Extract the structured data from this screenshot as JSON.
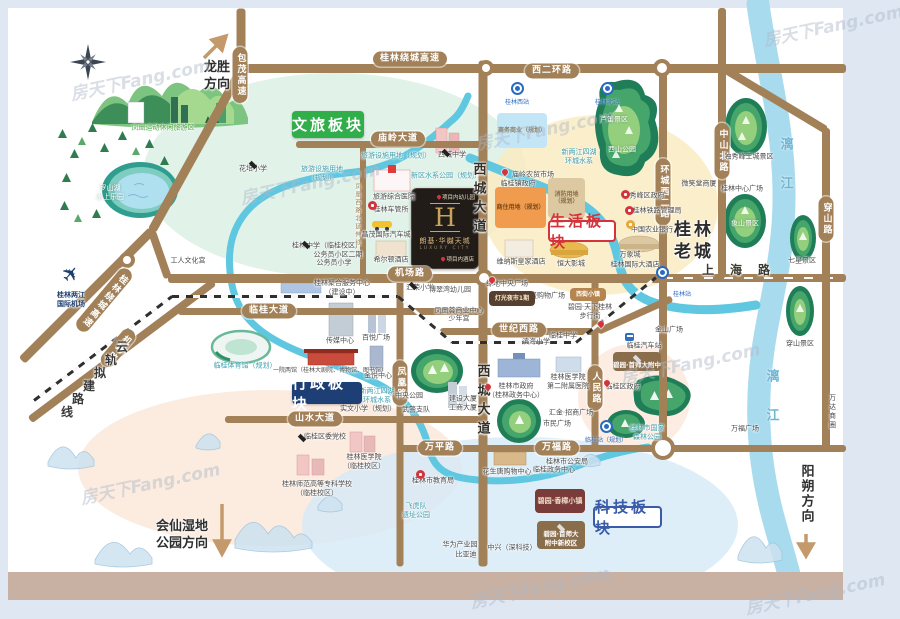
{
  "watermark": "房天下Fang.com",
  "colors": {
    "road": "#a28159",
    "green_badge": "#2fae49",
    "navy_badge": "#1e3e76",
    "red_accent": "#d5333b",
    "blue_accent": "#3a5ba8",
    "river": "#5fc7e0",
    "liriver": "#a9dbee"
  },
  "project": {
    "letter": "H",
    "name": "朗基·华樾天城",
    "subtitle": "LUXURY CITY",
    "kindergarten": "项目内幼儿园",
    "hotel": "项目内酒店"
  },
  "badges": [
    {
      "t": "文旅板块",
      "x": 292,
      "y": 111,
      "w": 72,
      "h": 27,
      "style": "solid",
      "bg": "#2fae49"
    },
    {
      "t": "生活板块",
      "x": 548,
      "y": 220,
      "w": 68,
      "h": 22,
      "style": "outline",
      "color": "#d5333b"
    },
    {
      "t": "行政板块",
      "x": 292,
      "y": 382,
      "w": 70,
      "h": 22,
      "style": "solid",
      "bg": "#1e3e76"
    },
    {
      "t": "科技板块",
      "x": 593,
      "y": 506,
      "w": 69,
      "h": 22,
      "style": "outline",
      "color": "#3a5ba8"
    }
  ],
  "directions": [
    {
      "t": "龙胜\n方向",
      "x": 217,
      "y": 77,
      "vert": 0
    },
    {
      "t": "会仙湿地\n公园方向",
      "x": 182,
      "y": 536,
      "vert": 0
    },
    {
      "t": "阳朔方向",
      "x": 805,
      "y": 494,
      "vert": 1
    }
  ],
  "roads": [
    {
      "x1": 237,
      "y1": 68,
      "x2": 846,
      "y2": 68,
      "w": 9
    },
    {
      "x1": 241,
      "y1": 8,
      "x2": 241,
      "y2": 70,
      "w": 9
    },
    {
      "x1": 243,
      "y1": 66,
      "x2": 152,
      "y2": 230,
      "w": 9
    },
    {
      "x1": 152,
      "y1": 230,
      "x2": 22,
      "y2": 360,
      "w": 9
    },
    {
      "x1": 214,
      "y1": 282,
      "x2": 30,
      "y2": 420,
      "w": 8
    },
    {
      "x1": 168,
      "y1": 278,
      "x2": 152,
      "y2": 232,
      "w": 8
    },
    {
      "x1": 296,
      "y1": 144,
      "x2": 484,
      "y2": 144,
      "w": 7
    },
    {
      "x1": 168,
      "y1": 278,
      "x2": 662,
      "y2": 278,
      "w": 9
    },
    {
      "x1": 662,
      "y1": 278,
      "x2": 846,
      "y2": 278,
      "w": 8,
      "cls": "dashcenter"
    },
    {
      "x1": 178,
      "y1": 311,
      "x2": 484,
      "y2": 311,
      "w": 7
    },
    {
      "x1": 440,
      "y1": 331,
      "x2": 598,
      "y2": 331,
      "w": 7
    },
    {
      "x1": 598,
      "y1": 331,
      "x2": 672,
      "y2": 298,
      "w": 7
    },
    {
      "x1": 225,
      "y1": 419,
      "x2": 484,
      "y2": 419,
      "w": 7
    },
    {
      "x1": 398,
      "y1": 448,
      "x2": 484,
      "y2": 448,
      "w": 7
    },
    {
      "x1": 484,
      "y1": 448,
      "x2": 846,
      "y2": 448,
      "w": 7
    },
    {
      "x1": 483,
      "y1": 60,
      "x2": 483,
      "y2": 566,
      "w": 9
    },
    {
      "x1": 363,
      "y1": 144,
      "x2": 363,
      "y2": 280,
      "w": 6
    },
    {
      "x1": 400,
      "y1": 278,
      "x2": 400,
      "y2": 566,
      "w": 7
    },
    {
      "x1": 595,
      "y1": 278,
      "x2": 595,
      "y2": 450,
      "w": 7
    },
    {
      "x1": 663,
      "y1": 68,
      "x2": 663,
      "y2": 450,
      "w": 8
    },
    {
      "x1": 722,
      "y1": 8,
      "x2": 722,
      "y2": 278,
      "w": 8
    },
    {
      "x1": 826,
      "y1": 128,
      "x2": 826,
      "y2": 450,
      "w": 8
    },
    {
      "x1": 726,
      "y1": 70,
      "x2": 826,
      "y2": 130,
      "w": 8
    }
  ],
  "rails": [
    {
      "x1": 34,
      "y1": 400,
      "x2": 172,
      "y2": 296
    },
    {
      "x1": 172,
      "y1": 296,
      "x2": 398,
      "y2": 296
    },
    {
      "x1": 398,
      "y1": 296,
      "x2": 452,
      "y2": 342
    },
    {
      "x1": 452,
      "y1": 342,
      "x2": 576,
      "y2": 342
    },
    {
      "x1": 576,
      "y1": 342,
      "x2": 656,
      "y2": 277
    }
  ],
  "junctions": [
    {
      "x": 486,
      "y": 68,
      "r": 8
    },
    {
      "x": 662,
      "y": 68,
      "r": 9
    },
    {
      "x": 484,
      "y": 278,
      "r": 9
    },
    {
      "x": 663,
      "y": 448,
      "r": 12
    },
    {
      "x": 127,
      "y": 260,
      "r": 8
    }
  ],
  "pills": [
    {
      "t": "桂林绕城高速",
      "x": 410,
      "y": 59
    },
    {
      "t": "西二环路",
      "x": 552,
      "y": 71
    },
    {
      "t": "包茂高速",
      "x": 240,
      "y": 75,
      "vert": 1
    },
    {
      "t": "庙岭大道",
      "x": 398,
      "y": 139
    },
    {
      "t": "机场路",
      "x": 410,
      "y": 274
    },
    {
      "t": "临桂大道",
      "x": 269,
      "y": 311
    },
    {
      "t": "世纪西路",
      "x": 519,
      "y": 330
    },
    {
      "t": "山水大道",
      "x": 315,
      "y": 419
    },
    {
      "t": "万平路",
      "x": 440,
      "y": 448
    },
    {
      "t": "万福路",
      "x": 557,
      "y": 448
    },
    {
      "t": "凤凰路",
      "x": 400,
      "y": 383,
      "vert": 1
    },
    {
      "t": "人民路",
      "x": 595,
      "y": 388,
      "vert": 1
    },
    {
      "t": "环城西二路",
      "x": 663,
      "y": 192,
      "vert": 1
    },
    {
      "t": "中山北路",
      "x": 722,
      "y": 151,
      "vert": 1
    },
    {
      "t": "穿山路",
      "x": 826,
      "y": 219,
      "vert": 1
    },
    {
      "t": "桂林绕城高速",
      "x": 104,
      "y": 300,
      "vert": 1,
      "rot": 40
    },
    {
      "t": "机场路",
      "x": 118,
      "y": 348,
      "vert": 1,
      "rot": 40
    }
  ],
  "stations": [
    {
      "t": "桂林西站",
      "x": 517,
      "y": 88
    },
    {
      "t": "桂林北站",
      "x": 607,
      "y": 88
    },
    {
      "t": "桂林站",
      "x": 662,
      "y": 272,
      "lx": 682,
      "ly": 289
    },
    {
      "t": "临桂站（规划）",
      "x": 606,
      "y": 426
    }
  ],
  "railchars": [
    [
      "云",
      122,
      348
    ],
    [
      "轨",
      111,
      361
    ],
    [
      "拟",
      100,
      374
    ],
    [
      "建",
      89,
      387
    ],
    [
      "路",
      78,
      400
    ],
    [
      "线",
      67,
      413
    ]
  ],
  "pois": [
    {
      "t": "凤凰运动休闲旅游区",
      "x": 163,
      "y": 128,
      "c": "g"
    },
    {
      "t": "罗山湖\n水上乐园",
      "x": 110,
      "y": 193,
      "c": "w"
    },
    {
      "t": "花培小学",
      "x": 253,
      "y": 169
    },
    {
      "t": "旅游设施用地（规划）",
      "x": 396,
      "y": 156,
      "c": "t"
    },
    {
      "t": "旅游设施用地\n（规划）",
      "x": 322,
      "y": 174,
      "c": "t"
    },
    {
      "t": "新区水系公园（规划）",
      "x": 446,
      "y": 176,
      "c": "t"
    },
    {
      "t": "西城中学",
      "x": 452,
      "y": 155
    },
    {
      "t": "旅游综合医院",
      "x": 394,
      "y": 197
    },
    {
      "t": "桂林车管所",
      "x": 391,
      "y": 210
    },
    {
      "t": "昌茂国际汽车城",
      "x": 386,
      "y": 235
    },
    {
      "t": "希尔顿酒店",
      "x": 391,
      "y": 260
    },
    {
      "t": "桂林中学（临桂校区）",
      "x": 327,
      "y": 246
    },
    {
      "t": "公务员小区二期",
      "x": 338,
      "y": 255
    },
    {
      "t": "公务员小学",
      "x": 334,
      "y": 263
    },
    {
      "t": "工人文化宫",
      "x": 188,
      "y": 261
    },
    {
      "t": "桂林两江\n国际机场",
      "x": 71,
      "y": 300,
      "c": "nav"
    },
    {
      "t": "桂林聚合服务中心\n（建设中）",
      "x": 342,
      "y": 288
    },
    {
      "t": "临桂体育馆（规划）",
      "x": 245,
      "y": 366,
      "c": "t"
    },
    {
      "t": "传媒中心",
      "x": 340,
      "y": 341
    },
    {
      "t": "百悦广场",
      "x": 376,
      "y": 338
    },
    {
      "t": "一院两馆（桂林大剧院、博物馆、图书馆）",
      "x": 330,
      "y": 371,
      "c": "sm"
    },
    {
      "t": "金悦中心",
      "x": 378,
      "y": 376
    },
    {
      "t": "新两江四湖\n环城水系",
      "x": 377,
      "y": 396,
      "c": "t"
    },
    {
      "t": "实文小学（规划）",
      "x": 368,
      "y": 409
    },
    {
      "t": "临桂区委党校",
      "x": 325,
      "y": 437
    },
    {
      "t": "桂林师范高等专科学校\n（临桂校区）",
      "x": 317,
      "y": 489
    },
    {
      "t": "桂林医学院\n（临桂校区）",
      "x": 364,
      "y": 462
    },
    {
      "t": "中央公园",
      "x": 409,
      "y": 396
    },
    {
      "t": "武警支队",
      "x": 416,
      "y": 410
    },
    {
      "t": "建设大厦",
      "x": 463,
      "y": 399
    },
    {
      "t": "工商大厦",
      "x": 463,
      "y": 408
    },
    {
      "t": "汇荣小学",
      "x": 420,
      "y": 288
    },
    {
      "t": "博翠湾幼儿园",
      "x": 450,
      "y": 290
    },
    {
      "t": "凤凰荟商业中心",
      "x": 459,
      "y": 311
    },
    {
      "t": "少年宫",
      "x": 459,
      "y": 319
    },
    {
      "t": "桂林市教育局",
      "x": 433,
      "y": 481
    },
    {
      "t": "飞虎队\n遗址公园",
      "x": 416,
      "y": 511,
      "c": "t"
    },
    {
      "t": "华为产业园",
      "x": 460,
      "y": 545
    },
    {
      "t": "比亚迪",
      "x": 466,
      "y": 555
    },
    {
      "t": "中兴（深科技）",
      "x": 512,
      "y": 548
    },
    {
      "t": "花生唐购物中心",
      "x": 507,
      "y": 472
    },
    {
      "t": "临桂政务中心",
      "x": 554,
      "y": 470
    },
    {
      "t": "桂林市公安局",
      "x": 567,
      "y": 462
    },
    {
      "t": "市民广场",
      "x": 557,
      "y": 424
    },
    {
      "t": "汇金·招商广场",
      "x": 571,
      "y": 413
    },
    {
      "t": "桂林市政府\n（桂林政务中心）",
      "x": 516,
      "y": 391
    },
    {
      "t": "桂林医学院\n第二附属医院",
      "x": 568,
      "y": 382
    },
    {
      "t": "临桂区政府",
      "x": 623,
      "y": 387
    },
    {
      "t": "临桂汽车站",
      "x": 644,
      "y": 346
    },
    {
      "t": "金山广场",
      "x": 669,
      "y": 330
    },
    {
      "t": "绿地中央广场",
      "x": 507,
      "y": 284
    },
    {
      "t": "华盛购物广场",
      "x": 544,
      "y": 296
    },
    {
      "t": "碧园·天下桂林\n步行街",
      "x": 590,
      "y": 312
    },
    {
      "t": "临桂中学",
      "x": 563,
      "y": 336
    },
    {
      "t": "滨海小学",
      "x": 536,
      "y": 342
    },
    {
      "t": "庙岭农贸市场",
      "x": 533,
      "y": 175
    },
    {
      "t": "临桂镇政府",
      "x": 518,
      "y": 184
    },
    {
      "t": "秀峰区政府",
      "x": 647,
      "y": 196
    },
    {
      "t": "桂林铁路管理局",
      "x": 657,
      "y": 211
    },
    {
      "t": "中国农业银行",
      "x": 652,
      "y": 230
    },
    {
      "t": "万象城",
      "x": 630,
      "y": 255
    },
    {
      "t": "桂林国际大酒店",
      "x": 635,
      "y": 265
    },
    {
      "t": "微笑堂商厦",
      "x": 699,
      "y": 184
    },
    {
      "t": "桂林中心广场",
      "x": 742,
      "y": 189
    },
    {
      "t": "独秀峰王城景区",
      "x": 749,
      "y": 157
    },
    {
      "t": "象山景区",
      "x": 745,
      "y": 224,
      "c": "w"
    },
    {
      "t": "七星景区",
      "x": 802,
      "y": 261
    },
    {
      "t": "穿山景区",
      "x": 800,
      "y": 344
    },
    {
      "t": "西山公园",
      "x": 622,
      "y": 150,
      "c": "w"
    },
    {
      "t": "芦笛景区",
      "x": 614,
      "y": 120,
      "c": "w"
    },
    {
      "t": "新两江四湖\n环城水系",
      "x": 579,
      "y": 157,
      "c": "t"
    },
    {
      "t": "万福广场",
      "x": 745,
      "y": 429
    },
    {
      "t": "万达商圈",
      "x": 832,
      "y": 412,
      "vert": 1
    },
    {
      "t": "桂林市国家\n森林公园",
      "x": 647,
      "y": 433,
      "c": "t"
    },
    {
      "t": "维纳斯皇家酒店",
      "x": 521,
      "y": 262
    },
    {
      "t": "恒大影城",
      "x": 571,
      "y": 264
    },
    {
      "t": "凤凰西路北延伸线",
      "x": 357,
      "y": 215,
      "c": "t2",
      "vert": 1
    },
    {
      "t": "桂林老城",
      "x": 694,
      "y": 241,
      "c": "big",
      "wd": 44
    },
    {
      "t": "西城大道",
      "x": 477,
      "y": 200,
      "c": "roadv"
    },
    {
      "t": "西城大道",
      "x": 481,
      "y": 402,
      "c": "roadv"
    },
    {
      "t": "上海路",
      "x": 744,
      "y": 271,
      "c": "roadh"
    },
    {
      "t": "漓江",
      "x": 784,
      "y": 176,
      "c": "riv"
    },
    {
      "t": "漓江",
      "x": 770,
      "y": 408,
      "c": "riv"
    }
  ],
  "boxes": [
    {
      "t": "商务商业（规划）",
      "x": 497,
      "y": 113,
      "w": 50,
      "h": 35,
      "bg": "#c3e6f7",
      "fg": "#8a7a5e",
      "fs": 6
    },
    {
      "t": "消防用地\n（规划）",
      "x": 548,
      "y": 178,
      "w": 37,
      "h": 40,
      "bg": "#dcc9a2",
      "fg": "#8a6f4a",
      "fs": 6
    },
    {
      "t": "商住用地（规划）",
      "x": 495,
      "y": 187,
      "w": 51,
      "h": 41,
      "bg": "#f09b4e",
      "fg": "#7a4d1e",
      "fs": 6
    },
    {
      "t": "灯光夜市1期",
      "x": 489,
      "y": 291,
      "w": 46,
      "h": 15,
      "bg": "#57402f",
      "fg": "#f5e7c8",
      "fs": 6
    },
    {
      "t": "西街小镇",
      "x": 570,
      "y": 288,
      "w": 36,
      "h": 13,
      "bg": "#b5854f",
      "fg": "#ffffff",
      "fs": 6
    },
    {
      "t": "碧园·首师大附中",
      "x": 613,
      "y": 352,
      "w": 48,
      "h": 19,
      "bg": "#8a6d4a",
      "fg": "#ffffff",
      "fs": 6.5,
      "cap": 1
    },
    {
      "t": "碧园·首师大\n附中新校区",
      "x": 537,
      "y": 521,
      "w": 48,
      "h": 28,
      "bg": "#8a6d4a",
      "fg": "#ffffff",
      "fs": 6.5,
      "cap": 1
    },
    {
      "t": "碧园·香樟小镇",
      "x": 535,
      "y": 489,
      "w": 50,
      "h": 24,
      "bg": "#7a3b3b",
      "fg": "#f0dfc8",
      "fs": 7
    }
  ],
  "pins": [
    {
      "x": 506,
      "y": 173,
      "k": "pin"
    },
    {
      "x": 493,
      "y": 281,
      "k": "pin"
    },
    {
      "x": 608,
      "y": 384,
      "k": "pin"
    },
    {
      "x": 602,
      "y": 325,
      "k": "pin"
    },
    {
      "x": 489,
      "y": 388,
      "k": "pin"
    },
    {
      "x": 372,
      "y": 205,
      "k": "ric"
    },
    {
      "x": 625,
      "y": 194,
      "k": "ric"
    },
    {
      "x": 629,
      "y": 210,
      "k": "ric"
    },
    {
      "x": 420,
      "y": 474,
      "k": "ric"
    },
    {
      "x": 630,
      "y": 224,
      "k": "yic"
    },
    {
      "x": 629,
      "y": 337,
      "k": "bus"
    }
  ],
  "caps": [
    [
      248,
      160
    ],
    [
      441,
      148
    ],
    [
      301,
      240
    ],
    [
      297,
      433
    ],
    [
      408,
      281
    ]
  ],
  "watermarks": [
    {
      "x": 140,
      "y": 78,
      "r": -12
    },
    {
      "x": 833,
      "y": 24,
      "r": -12
    },
    {
      "x": 310,
      "y": 182,
      "r": -12
    },
    {
      "x": 545,
      "y": 128,
      "r": -12
    },
    {
      "x": 690,
      "y": 362,
      "r": -12
    },
    {
      "x": 150,
      "y": 482,
      "r": -12
    },
    {
      "x": 540,
      "y": 586,
      "r": -12
    },
    {
      "x": 815,
      "y": 592,
      "r": -12
    }
  ],
  "misc": {
    "plane_icon": "✈",
    "plane_x": 62,
    "plane_y": 262
  }
}
